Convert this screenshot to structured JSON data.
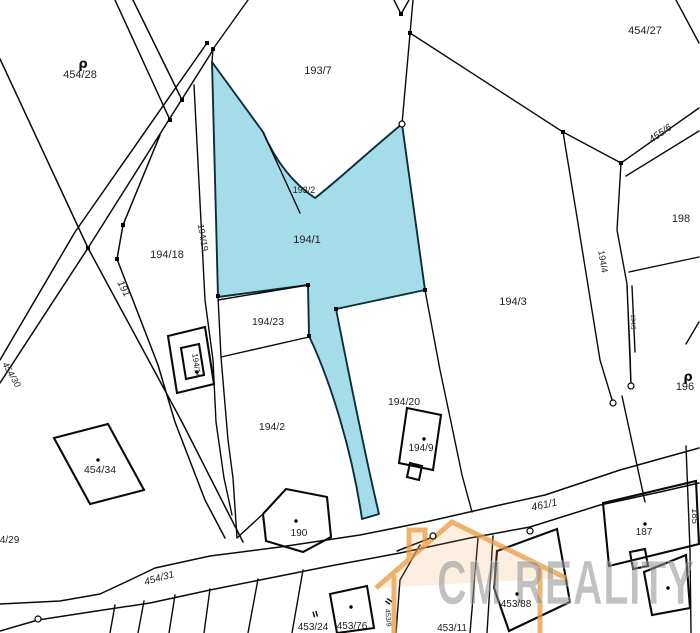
{
  "title": "Cadastral parcel map",
  "colors": {
    "background": "#ffffff",
    "line": "#0a0a0a",
    "highlight": "#a5dce9",
    "watermark_text": "#8f8f8f",
    "watermark_house": "#e89a3e"
  },
  "watermark": {
    "text": "CM REALITY",
    "house_icon": "house-with-chimney"
  },
  "highlighted_parcels": [
    "194/1",
    "193/2"
  ],
  "labels": [
    {
      "t": "454/28",
      "x": 80,
      "y": 78,
      "r": 0,
      "s": 11
    },
    {
      "t": "193/7",
      "x": 318,
      "y": 74,
      "r": 0,
      "s": 11
    },
    {
      "t": "454/27",
      "x": 645,
      "y": 34,
      "r": 0,
      "s": 11
    },
    {
      "t": "455/6",
      "x": 662,
      "y": 136,
      "r": -35,
      "s": 10,
      "i": true
    },
    {
      "t": "193/2",
      "x": 304,
      "y": 193,
      "r": 0,
      "s": 9
    },
    {
      "t": "194/1",
      "x": 307,
      "y": 243,
      "r": 0,
      "s": 11
    },
    {
      "t": "198",
      "x": 681,
      "y": 222,
      "r": 0,
      "s": 11
    },
    {
      "t": "194/19",
      "x": 200,
      "y": 238,
      "r": 80,
      "s": 9
    },
    {
      "t": "194/18",
      "x": 167,
      "y": 258,
      "r": 0,
      "s": 11
    },
    {
      "t": "194/3",
      "x": 513,
      "y": 305,
      "r": 0,
      "s": 11
    },
    {
      "t": "194/4",
      "x": 600,
      "y": 262,
      "r": 81,
      "s": 9
    },
    {
      "t": "194/5",
      "x": 631,
      "y": 322,
      "r": 90,
      "s": 6
    },
    {
      "t": "191",
      "x": 121,
      "y": 290,
      "r": 62,
      "s": 10,
      "i": true
    },
    {
      "t": "454/30",
      "x": 9,
      "y": 376,
      "r": 60,
      "s": 9,
      "i": true
    },
    {
      "t": "196",
      "x": 685,
      "y": 390,
      "r": 0,
      "s": 11
    },
    {
      "t": "194/23",
      "x": 268,
      "y": 325,
      "r": 0,
      "s": 10.5
    },
    {
      "t": "194/14",
      "x": 194,
      "y": 366,
      "r": 81,
      "s": 8
    },
    {
      "t": "194/20",
      "x": 404,
      "y": 405,
      "r": 0,
      "s": 10.5
    },
    {
      "t": "194/2",
      "x": 272,
      "y": 430,
      "r": 0,
      "s": 10.5
    },
    {
      "t": "194/9",
      "x": 421,
      "y": 451,
      "r": 0,
      "s": 10
    },
    {
      "t": "454/34",
      "x": 100,
      "y": 473,
      "r": 0,
      "s": 10.5
    },
    {
      "t": "461/1",
      "x": 545,
      "y": 508,
      "r": -12,
      "s": 10.5,
      "i": true
    },
    {
      "t": "185",
      "x": 692,
      "y": 516,
      "r": 90,
      "s": 9.5
    },
    {
      "t": "187",
      "x": 644,
      "y": 535,
      "r": 0,
      "s": 10
    },
    {
      "t": "190",
      "x": 299,
      "y": 536,
      "r": 0,
      "s": 10
    },
    {
      "t": "454/29",
      "x": 4,
      "y": 543,
      "r": 0,
      "s": 10,
      "a": "start"
    },
    {
      "t": "454/31",
      "x": 160,
      "y": 581,
      "r": -16,
      "s": 10,
      "i": true
    },
    {
      "t": "453/88",
      "x": 516,
      "y": 607,
      "r": 0,
      "s": 10
    },
    {
      "t": "453/24",
      "x": 313,
      "y": 630,
      "r": 0,
      "s": 10
    },
    {
      "t": "453/76",
      "x": 352,
      "y": 629,
      "r": 0,
      "s": 10
    },
    {
      "t": "453/9",
      "x": 386,
      "y": 618,
      "r": 85,
      "s": 7
    },
    {
      "t": "453/11",
      "x": 452,
      "y": 631,
      "r": 0,
      "s": 10
    }
  ],
  "symbols": [
    {
      "t": "ρ",
      "x": 83,
      "y": 68,
      "r": 0,
      "s": 13,
      "name": "landuse-symbol"
    },
    {
      "t": "ρ",
      "x": 688,
      "y": 381,
      "r": 0,
      "s": 13,
      "name": "landuse-symbol"
    },
    {
      "t": "II",
      "x": 316,
      "y": 617,
      "r": -15,
      "s": 8,
      "name": "boundary-symbol"
    },
    {
      "t": "II",
      "x": 391,
      "y": 603,
      "r": -55,
      "s": 8,
      "name": "boundary-symbol"
    }
  ],
  "vertex_markers": [
    [
      207,
      43
    ],
    [
      213,
      49
    ],
    [
      170,
      120
    ],
    [
      182,
      100
    ],
    [
      88,
      248
    ],
    [
      123,
      225
    ],
    [
      117,
      259
    ],
    [
      425,
      290
    ],
    [
      308,
      285
    ],
    [
      309,
      336
    ],
    [
      336,
      309
    ],
    [
      218,
      296
    ],
    [
      563,
      132
    ],
    [
      621,
      163
    ],
    [
      410,
      33
    ],
    [
      401,
      14
    ]
  ],
  "junction_markers": [
    [
      38,
      619
    ],
    [
      433,
      536
    ],
    [
      530,
      531
    ],
    [
      613,
      403
    ],
    [
      631,
      386
    ],
    [
      402,
      124
    ]
  ],
  "building_dots": [
    [
      98,
      460
    ],
    [
      296,
      521
    ],
    [
      351,
      607
    ],
    [
      424,
      439
    ],
    [
      517,
      594
    ],
    [
      645,
      524
    ],
    [
      668,
      588
    ],
    [
      197,
      372
    ]
  ]
}
